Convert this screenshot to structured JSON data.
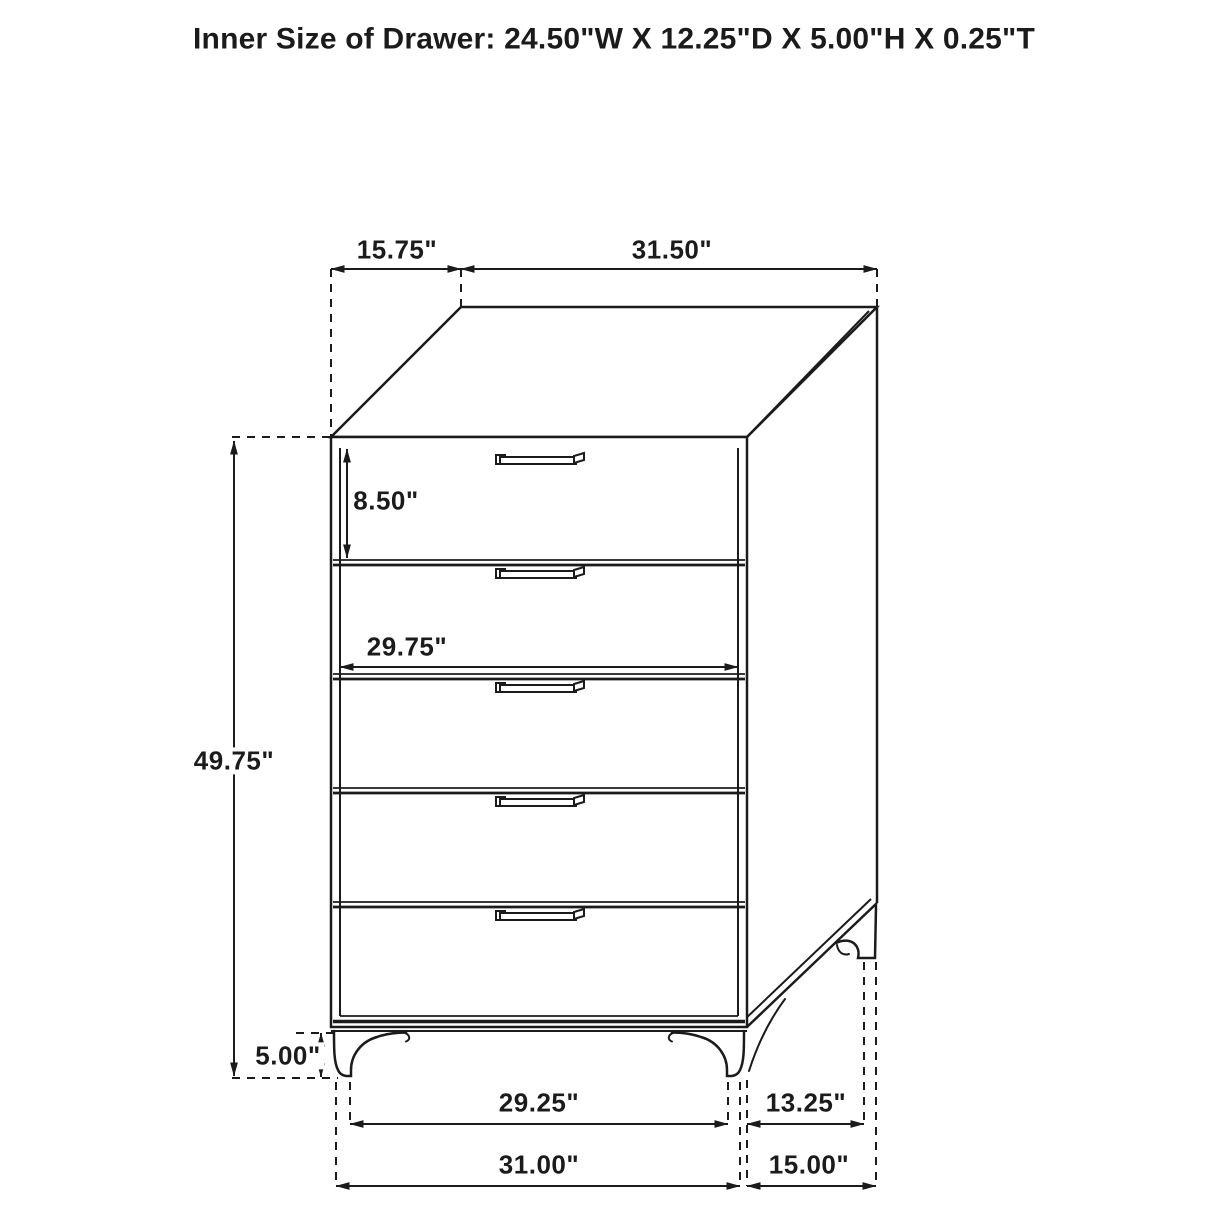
{
  "title": "Inner Size of Drawer: 24.50\"W X 12.25\"D X 5.00\"H X 0.25\"T",
  "dimensions": {
    "top_depth": "15.75\"",
    "top_width": "31.50\"",
    "drawer_front_height": "8.50\"",
    "drawer_front_width": "29.75\"",
    "overall_height": "49.75\"",
    "leg_height": "5.00\"",
    "front_feet_span": "29.25\"",
    "side_feet_span": "13.25\"",
    "overall_width": "31.00\"",
    "overall_depth": "15.00\""
  },
  "drawer_count": 5,
  "colors": {
    "ink": "#1b1b1b",
    "background": "#ffffff"
  }
}
